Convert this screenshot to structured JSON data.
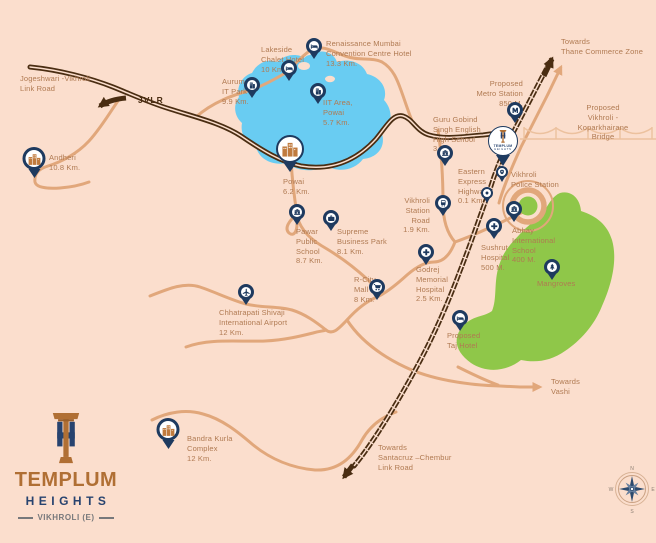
{
  "colors": {
    "background": "#fbdecd",
    "road": "#e1a77b",
    "road_dark": "#4a2d12",
    "lake": "#69ccf2",
    "greenery": "#8fc749",
    "pin": "#1e3a5f",
    "accent": "#c07b3e",
    "label": "#b07a52",
    "logo_brown": "#b06f34",
    "logo_navy": "#27436f",
    "logo_gray": "#77787b"
  },
  "project": {
    "name": "TEMPLUM",
    "sub": "HEIGHTS",
    "location_tag": "VIKHROLI (E)"
  },
  "compass": {
    "north": "N",
    "east": "E",
    "south": "S",
    "west": "W"
  },
  "map": {
    "road_labels": [
      {
        "id": "jogeshwari-vikhroli-link-road",
        "lines": "Jogeshwari -Vikhroli\nLink Road",
        "x": 20,
        "y": 74
      },
      {
        "id": "jvlr",
        "lines": "JVLR",
        "x": 138,
        "y": 95,
        "style": "dark"
      },
      {
        "id": "towards-thane-commerce-zone",
        "lines": "Towards\nThane Commerce Zone",
        "x": 561,
        "y": 37
      },
      {
        "id": "proposed-vikhroli-koparkhairane-bridge",
        "lines": "Proposed\nVikhroli - Koparkhairane Bridge",
        "x": 603,
        "y": 103,
        "align": "center"
      },
      {
        "id": "towards-vashi",
        "lines": "Towards\nVashi",
        "x": 551,
        "y": 377
      },
      {
        "id": "towards-santacruz-chembur-link-road",
        "lines": "Towards\nSantacruz –Chembur\nLink Road",
        "x": 378,
        "y": 443
      }
    ],
    "locations": [
      {
        "id": "andheri",
        "name": "Andheri",
        "distance": "10.8 Km.",
        "icon": "city",
        "pin": {
          "x": 34,
          "y": 178,
          "size": "md"
        },
        "label": {
          "x": 49,
          "y": 153,
          "lines": "Andheri\n10.8 Km."
        }
      },
      {
        "id": "aurum-it-park",
        "name": "Aurum IT Park",
        "distance": "9.9 Km.",
        "icon": "building",
        "pin": {
          "x": 252,
          "y": 98,
          "size": "sm"
        },
        "label": {
          "x": 222,
          "y": 77,
          "lines": "Aurum\nIT Park\n9.9 Km."
        }
      },
      {
        "id": "lakeside-chalet-hotel",
        "name": "Lakeside Chalet Hotel",
        "distance": "10 Km.",
        "icon": "bed",
        "pin": {
          "x": 289,
          "y": 81,
          "size": "sm"
        },
        "label": {
          "x": 261,
          "y": 45,
          "lines": "Lakeside\nChalet Hotel\n10 Km."
        }
      },
      {
        "id": "renaissance-hotel",
        "name": "Renaissance Mumbai Convention Centre Hotel",
        "distance": "13.3 Km.",
        "icon": "bed",
        "pin": {
          "x": 314,
          "y": 59,
          "size": "sm"
        },
        "label": {
          "x": 326,
          "y": 39,
          "lines": "Renaissance Mumbai\nConvention Centre Hotel\n13.3 Km."
        }
      },
      {
        "id": "iit-area-powai",
        "name": "IIT Area, Powai",
        "distance": "5.7 Km.",
        "icon": "building",
        "pin": {
          "x": 318,
          "y": 104,
          "size": "sm"
        },
        "label": {
          "x": 323,
          "y": 98,
          "lines": "IIT Area,\nPowai\n5.7 Km."
        }
      },
      {
        "id": "powai",
        "name": "Powai",
        "distance": "6.2 Km.",
        "icon": "city",
        "pin": {
          "x": 290,
          "y": 172,
          "size": "lg"
        },
        "label": {
          "x": 283,
          "y": 177,
          "lines": "Powai\n6.2 Km."
        }
      },
      {
        "id": "pawar-public-school",
        "name": "Pawar Public School",
        "distance": "8.7 Km.",
        "icon": "school",
        "pin": {
          "x": 297,
          "y": 225,
          "size": "sm"
        },
        "label": {
          "x": 296,
          "y": 227,
          "lines": "Pawar\nPublic\nSchool\n8.7 Km."
        }
      },
      {
        "id": "supreme-business-park",
        "name": "Supreme Business Park",
        "distance": "8.1 Km.",
        "icon": "briefcase",
        "pin": {
          "x": 331,
          "y": 231,
          "size": "sm"
        },
        "label": {
          "x": 337,
          "y": 227,
          "lines": "Supreme\nBusiness Park\n8.1 Km."
        }
      },
      {
        "id": "vikhroli-station-road",
        "name": "Vikhroli Station Road",
        "distance": "1.9 Km.",
        "icon": "train",
        "pin": {
          "x": 443,
          "y": 216,
          "size": "sm"
        },
        "label": {
          "x": 430,
          "y": 196,
          "align": "right",
          "lines": "Vikhroli\nStation\nRoad\n1.9 Km."
        }
      },
      {
        "id": "guru-gobind-school",
        "name": "Guru Gobind Singh English High School",
        "distance": "3 Km.",
        "icon": "school",
        "pin": {
          "x": 445,
          "y": 166,
          "size": "sm"
        },
        "label": {
          "x": 433,
          "y": 115,
          "lines": "Guru Gobind\nSingh English\nHigh School\n3 Km."
        }
      },
      {
        "id": "proposed-metro-station",
        "name": "Proposed Metro Station",
        "distance": "850 M.",
        "icon": "metro",
        "pin": {
          "x": 515,
          "y": 123,
          "size": "sm"
        },
        "label": {
          "x": 523,
          "y": 79,
          "align": "right",
          "lines": "Proposed\nMetro Station\n850 M."
        }
      },
      {
        "id": "templum-heights",
        "name": "Templum Heights",
        "distance": null,
        "icon": "logo",
        "pin": {
          "x": 503,
          "y": 166,
          "size": "xl"
        },
        "label": null
      },
      {
        "id": "eastern-express-highway",
        "name": "Eastern Express Highway",
        "distance": "0.1 Km.",
        "icon": "marker",
        "pin": {
          "x": 487,
          "y": 203,
          "size": "xs"
        },
        "label": {
          "x": 458,
          "y": 167,
          "lines": "Eastern\nExpress\nHighway\n0.1 Km."
        }
      },
      {
        "id": "vikhroli-police-station",
        "name": "Vikhroli Police Station",
        "distance": null,
        "icon": "police",
        "pin": {
          "x": 502,
          "y": 182,
          "size": "xs"
        },
        "label": {
          "x": 511,
          "y": 170,
          "lines": "Vikhroli\nPolice Station"
        }
      },
      {
        "id": "abhay-international-school",
        "name": "Abhay International School",
        "distance": "400 M.",
        "icon": "school",
        "pin": {
          "x": 514,
          "y": 222,
          "size": "sm"
        },
        "label": {
          "x": 512,
          "y": 226,
          "lines": "Abhay\nInternational\nSchool\n400 M."
        }
      },
      {
        "id": "sushrut-hospital",
        "name": "Sushrut Hospital",
        "distance": "500 M.",
        "icon": "hospital",
        "pin": {
          "x": 494,
          "y": 239,
          "size": "sm"
        },
        "label": {
          "x": 481,
          "y": 243,
          "lines": "Sushrut\nHospital\n500 M."
        }
      },
      {
        "id": "godrej-memorial-hospital",
        "name": "Godrej Memorial Hospital",
        "distance": "2.5 Km.",
        "icon": "hospital",
        "pin": {
          "x": 426,
          "y": 265,
          "size": "sm"
        },
        "label": {
          "x": 416,
          "y": 265,
          "lines": "Godrej\nMemorial\nHospital\n2.5 Km."
        }
      },
      {
        "id": "r-city-mall",
        "name": "R-City Mall",
        "distance": "8 Km.",
        "icon": "cart",
        "pin": {
          "x": 377,
          "y": 300,
          "size": "sm"
        },
        "label": {
          "x": 354,
          "y": 275,
          "lines": "R-City\nMall\n8 Km."
        }
      },
      {
        "id": "chhatrapati-shivaji-airport",
        "name": "Chhatrapati Shivaji International Airport",
        "distance": "12 Km.",
        "icon": "plane",
        "pin": {
          "x": 246,
          "y": 305,
          "size": "sm"
        },
        "label": {
          "x": 219,
          "y": 308,
          "lines": "Chhatrapati Shivaji\nInternational Airport\n12 Km."
        }
      },
      {
        "id": "proposed-taj-hotel",
        "name": "Proposed Taj Hotel",
        "distance": null,
        "icon": "bed",
        "pin": {
          "x": 460,
          "y": 331,
          "size": "sm"
        },
        "label": {
          "x": 447,
          "y": 331,
          "lines": "Proposed\nTaj Hotel"
        }
      },
      {
        "id": "mangroves",
        "name": "Mangroves",
        "distance": null,
        "icon": "tree",
        "pin": {
          "x": 552,
          "y": 280,
          "size": "sm"
        },
        "label": {
          "x": 537,
          "y": 279,
          "lines": "Mangroves"
        }
      },
      {
        "id": "bandra-kurla-complex",
        "name": "Bandra Kurla Complex",
        "distance": "12 Km.",
        "icon": "city",
        "pin": {
          "x": 168,
          "y": 449,
          "size": "md"
        },
        "label": {
          "x": 187,
          "y": 434,
          "lines": "Bandra Kurla\nComplex\n12 Km."
        }
      }
    ]
  }
}
